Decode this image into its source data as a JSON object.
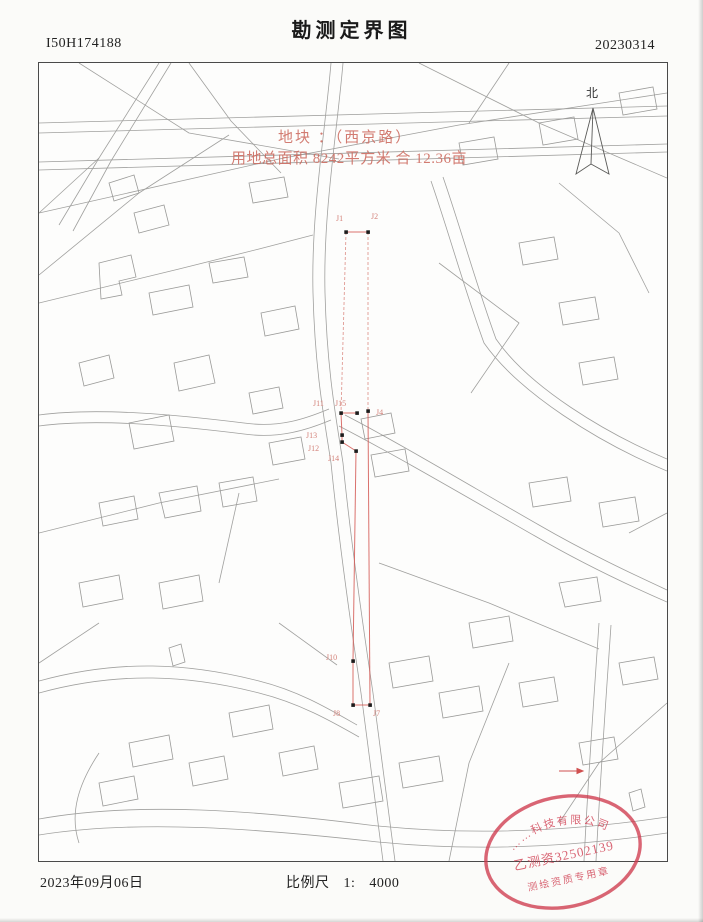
{
  "header": {
    "sheet_no": "I50H174188",
    "title": "勘测定界图",
    "date_code": "20230314"
  },
  "map": {
    "north_label": "北",
    "plot_note_line1": "地块 ：（西京路）",
    "plot_note_line2": "用地总面积 8242平方米 合 12.36亩",
    "boundary_points": [
      {
        "label": "J1"
      },
      {
        "label": "J2"
      },
      {
        "label": "J11"
      },
      {
        "label": "J15"
      },
      {
        "label": "J4"
      },
      {
        "label": "J13"
      },
      {
        "label": "J12"
      },
      {
        "label": "J14"
      },
      {
        "label": "J10"
      },
      {
        "label": "J8"
      },
      {
        "label": "J7"
      }
    ],
    "boundary_color": "#d45a55",
    "map_line_color": "#a0a09e"
  },
  "stamp": {
    "arc_text": "……科技有限公司",
    "code_text": "乙测资32502139",
    "bottom_text": "测绘资质专用章",
    "color": "#cf3b4e"
  },
  "footer": {
    "date": "2023年09月06日",
    "scale_label": "比例尺",
    "scale_value": "1:",
    "scale_denominator": "4000"
  }
}
